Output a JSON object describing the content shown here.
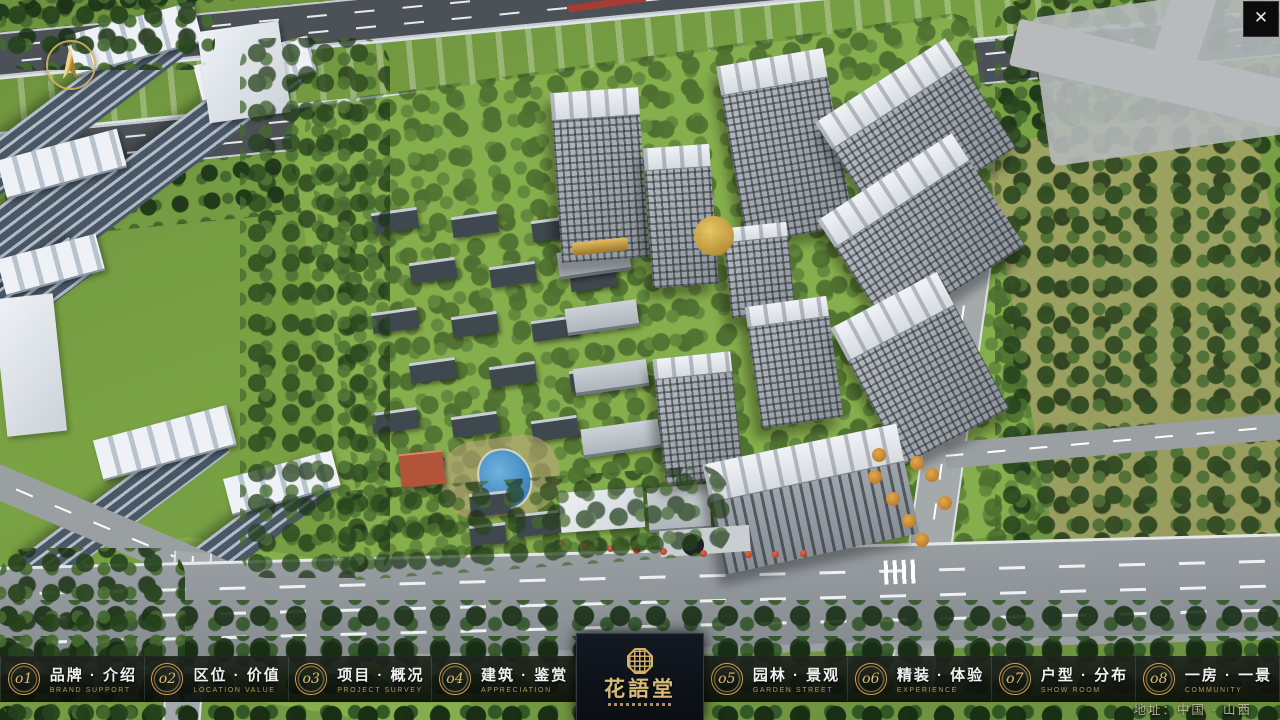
{
  "window": {
    "close_glyph": "✕"
  },
  "menu": {
    "items": [
      {
        "num": "o1",
        "label": "品牌 · 介绍",
        "sub": "BRAND SUPPORT"
      },
      {
        "num": "o2",
        "label": "区位 · 价值",
        "sub": "LOCATION VALUE"
      },
      {
        "num": "o3",
        "label": "项目 · 概况",
        "sub": "PROJECT SURVEY"
      },
      {
        "num": "o4",
        "label": "建筑 · 鉴赏",
        "sub": "APPRECIATION"
      },
      {
        "num": "o5",
        "label": "园林 · 景观",
        "sub": "GARDEN STREET"
      },
      {
        "num": "o6",
        "label": "精装 · 体验",
        "sub": "EXPERIENCE"
      },
      {
        "num": "o7",
        "label": "户型 · 分布",
        "sub": "SHOW ROOM"
      },
      {
        "num": "o8",
        "label": "一房 · 一景",
        "sub": "COMMUNITY"
      }
    ]
  },
  "logo": {
    "name": "花語堂"
  },
  "footer": {
    "address": "地址：中国 · 山西"
  },
  "colors": {
    "gold": "#c9a263",
    "river": "#2d6dbe",
    "bar_bg": "rgba(12,16,12,0.9)"
  }
}
